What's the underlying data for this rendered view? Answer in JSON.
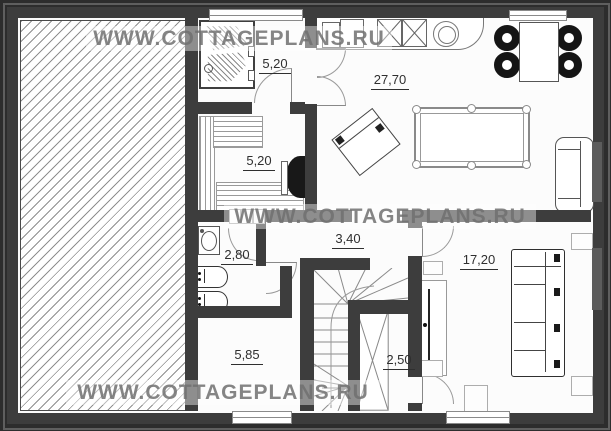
{
  "watermark": {
    "text": "WWW.COTTAGEPLANS.RU"
  },
  "rooms": {
    "shower": {
      "label": "5,20"
    },
    "sauna": {
      "label": "5,20"
    },
    "living_kitchen": {
      "label": "27,70"
    },
    "hall_upper": {
      "label": "3,40"
    },
    "bathroom": {
      "label": "2,80"
    },
    "bedroom": {
      "label": "17,20"
    },
    "hall_lower": {
      "label": "5,85"
    },
    "closet": {
      "label": "2,50"
    }
  },
  "colors": {
    "wall": "#3d3d3d",
    "outer_background": "#2d2d2d",
    "frame_highlight": "#5f5f5f",
    "floor": "#fcfcfc",
    "hatch_line": "#8f8f8f",
    "label_text": "#2f2f2f",
    "watermark_text": "#707070",
    "watermark_band": "rgba(255,255,255,0.42)"
  },
  "symbols": {
    "hatched-area": "unheated/garage zone with diagonal hatching",
    "shower-cabin": "shower box with hatched glass",
    "sauna-stove": "black heater on sauna wall",
    "kitchen-counter": "counter with fridge, cooktop (X squares), round sink",
    "dining-table": "table with four black chairs",
    "pool-table": "billiard table with six pockets",
    "armchair": "rotated armchair",
    "sofa": "small sofa at living room wall",
    "washbasin": "oval basin",
    "toilet": "two toilets on bathroom wall",
    "staircase": "U-shaped winder stair with direction arrow",
    "wardrobe": "tall closet with X cross",
    "tv-panel": "wall TV unit",
    "corner-sofa": "large sectional sofa in bedroom",
    "door-arc": "door swing quarter-circle",
    "window": "triple-line window in wall"
  }
}
